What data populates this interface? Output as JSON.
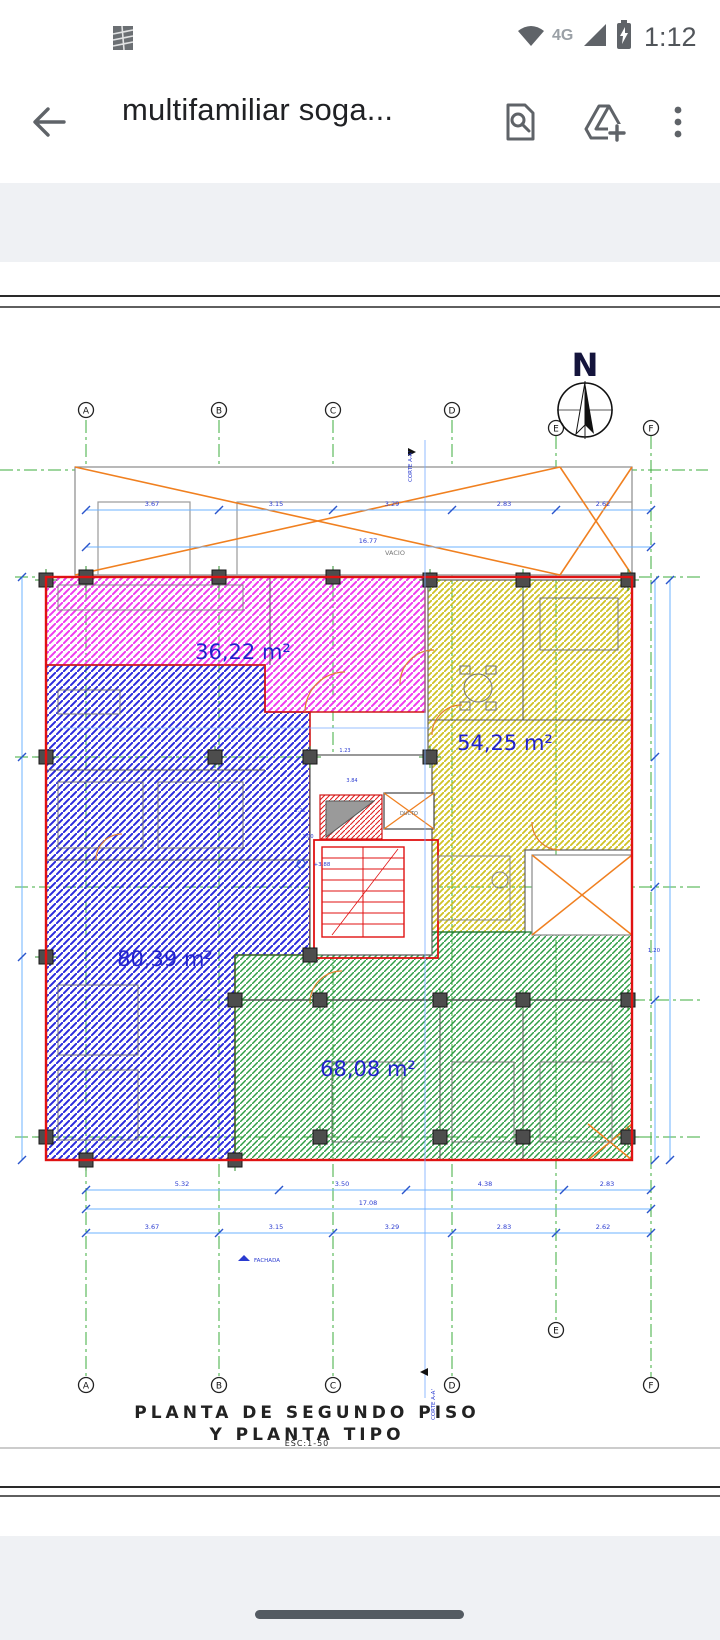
{
  "status_bar": {
    "time": "1:12",
    "network_label": "4G",
    "icons": [
      "notification-thumbnail-icon",
      "wifi-icon",
      "signal-icon",
      "battery-charging-icon"
    ]
  },
  "app_bar": {
    "title": "multifamiliar soga...",
    "icons": [
      "back-arrow-icon",
      "find-in-page-icon",
      "drive-add-icon",
      "overflow-menu-icon"
    ]
  },
  "plan": {
    "north_label": "N",
    "grid_columns": [
      "A",
      "B",
      "C",
      "D",
      "E",
      "F"
    ],
    "apartments": [
      {
        "location": "top-left",
        "area_label": "36,22 m²",
        "hatch_color": "#ee3cee"
      },
      {
        "location": "top-right",
        "area_label": "54,25 m²",
        "hatch_color": "#cfc226"
      },
      {
        "location": "left",
        "area_label": "80,39 m²",
        "hatch_color": "#2b2bdd"
      },
      {
        "location": "bottom",
        "area_label": "68,08 m²",
        "hatch_color": "#2f9e46"
      }
    ],
    "labels": {
      "void": "VACIO",
      "duct": "DUCTO",
      "section": "CORTE A-A'",
      "facade": "FACHADA",
      "level": "+3.88",
      "right_dim": "1.20",
      "core_dims": [
        "3.84",
        "1.23",
        "1.21",
        "1.00"
      ]
    },
    "dims_top": [
      "3.67",
      "3.15",
      "3.29",
      "2.83",
      "2.62"
    ],
    "dims_top_total": "16.77",
    "dims_bottom": [
      "5.32",
      "3.50",
      "4.38",
      "2.83"
    ],
    "dims_bottom_total": "17.08",
    "dims_bottom2": [
      "3.67",
      "3.15",
      "3.29",
      "2.83",
      "2.62"
    ],
    "title_line1": "PLANTA DE SEGUNDO PISO",
    "title_line2": "Y PLANTA TIPO",
    "scale_label": "ESC:1-50",
    "colors": {
      "grid_green": "#3dac3d",
      "dim_line": "#6db3ff",
      "dim_text": "#2a3bd0",
      "outline_red": "#e01212",
      "brace_orange": "#f08020",
      "area_text": "#2222cc"
    }
  }
}
